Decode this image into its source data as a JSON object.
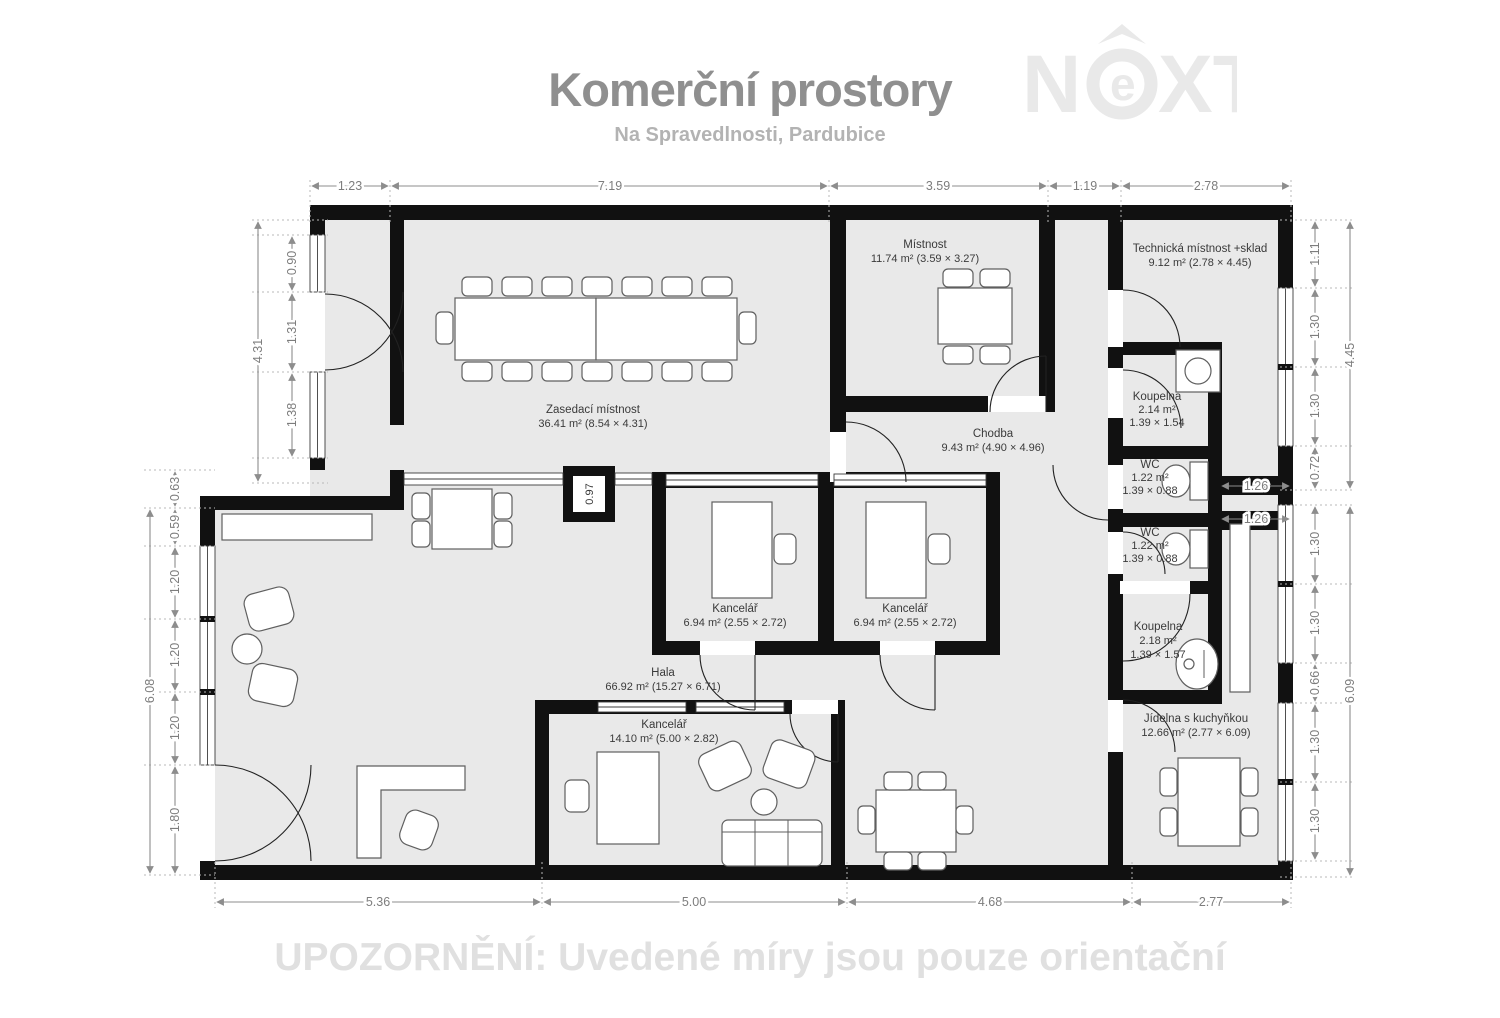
{
  "header": {
    "title": "Komerční prostory",
    "subtitle": "Na Spravedlnosti, Pardubice"
  },
  "logo": {
    "n": "N",
    "e": "e",
    "xt": "XT"
  },
  "footer": {
    "warning": "UPOZORNĚNÍ: Uvedené míry jsou pouze orientační"
  },
  "colors": {
    "floor": "#e9e9e9",
    "wall": "#111111",
    "dimension": "#8d8d8d",
    "title": "#8f8f8f",
    "subtitle": "#b3b3b3",
    "watermark": "#e0e0e0",
    "logo": "#e9e9e9"
  },
  "rooms": {
    "zasedaci": {
      "name": "Zasedací místnost",
      "area": "36.41 m² (8.54 × 4.31)"
    },
    "mistnost": {
      "name": "Místnost",
      "area": "11.74 m² (3.59 × 3.27)"
    },
    "technicka": {
      "name": "Technická místnost +sklad",
      "area": "9.12 m² (2.78 × 4.45)"
    },
    "chodba": {
      "name": "Chodba",
      "area": "9.43 m² (4.90 × 4.96)"
    },
    "koupelna1": {
      "name": "Koupelna",
      "area": "2.14 m²",
      "size": "1.39 × 1.54"
    },
    "wc1": {
      "name": "WC",
      "area": "1.22 m²",
      "size": "1.39 × 0.88"
    },
    "wc2": {
      "name": "WC",
      "area": "1.22 m²",
      "size": "1.39 × 0.88"
    },
    "koupelna2": {
      "name": "Koupelna",
      "area": "2.18 m²",
      "size": "1.39 × 1.57"
    },
    "kancelar1": {
      "name": "Kancelář",
      "area": "6.94 m² (2.55 × 2.72)"
    },
    "kancelar2": {
      "name": "Kancelář",
      "area": "6.94 m² (2.55 × 2.72)"
    },
    "hala": {
      "name": "Hala",
      "area": "66.92 m² (15.27 × 6.71)"
    },
    "kancelar3": {
      "name": "Kancelář",
      "area": "14.10 m² (5.00 × 2.82)"
    },
    "jidelna": {
      "name": "Jídelna s kuchyňkou",
      "area": "12.66 m² (2.77 × 6.09)"
    }
  },
  "dims": {
    "top": [
      "1.23",
      "7.19",
      "3.59",
      "1.19",
      "2.78"
    ],
    "bottom": [
      "5.36",
      "5.00",
      "4.68",
      "2.77"
    ],
    "left_upper": [
      "0.90",
      "1.31",
      "1.38"
    ],
    "left_upper_total": "4.31",
    "left_lower": [
      "0.63",
      "0.59",
      "1.20",
      "1.20",
      "1.20",
      "1.80"
    ],
    "left_lower_total": "6.08",
    "right_upper": [
      "1.11",
      "1.30",
      "1.30",
      "0.72"
    ],
    "right_upper_total": "4.45",
    "right_mid": [
      "1.26",
      "1.26"
    ],
    "right_lower": [
      "1.30",
      "1.30",
      "0.66",
      "1.30",
      "1.30"
    ],
    "right_lower_total": "6.09",
    "shaft": "0.97"
  }
}
